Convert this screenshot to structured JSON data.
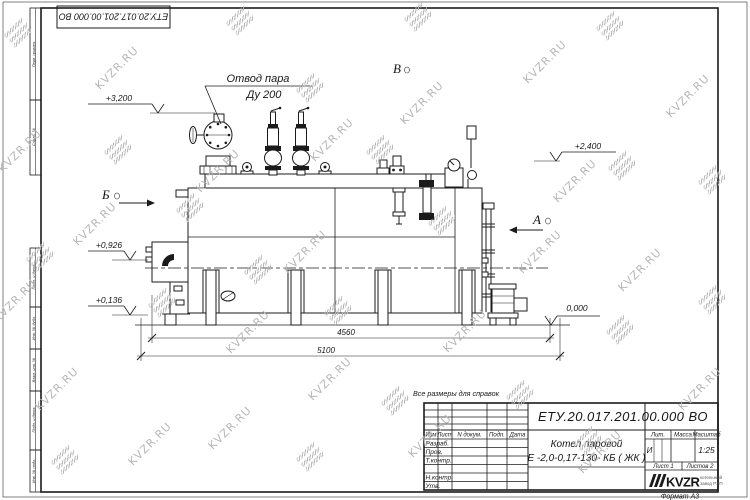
{
  "doc": {
    "number": "ЕТУ.20.017.201.00.000  ВО"
  },
  "notes": {
    "reference": "Все размеры для справок",
    "format": "Формат А3"
  },
  "frame": {
    "side_columns": [
      "Перв. примен.",
      "Справ. №",
      "Подп. и дата",
      "Инв. № дубл.",
      "Взам. инв. №",
      "Подп. и дата",
      "Инв. № подл."
    ]
  },
  "drawing": {
    "callout": {
      "line1": "Отвод пара",
      "line2": "Ду 200"
    },
    "views": {
      "b": "Б",
      "a": "А",
      "v": "В"
    },
    "elevations": {
      "top": "+3,200",
      "drum": "+2,400",
      "burner": "+0,926",
      "base": "+0,136",
      "ground": "0,000"
    },
    "dimensions": {
      "axes": "4560",
      "overall": "5100"
    }
  },
  "title_block": {
    "name_line1": "Котел паровой",
    "name_line2": "Е -2,0-0,17-130- КБ ( ЖК )",
    "header_cols": [
      "Изм",
      "Лист",
      "N докум.",
      "Подп.",
      "Дата"
    ],
    "sig_rows": [
      "Разраб.",
      "Пров.",
      "Т.контр.",
      "Н.контр.",
      "Утв."
    ],
    "lit_label": "Лит.",
    "mass_label": "Масса",
    "scale_label": "Масштаб",
    "lit_value": "И",
    "scale_value": "1:25",
    "sheet_cell": "Лист 1",
    "sheets_cell": "Листов 2",
    "logo_text": "KVZR",
    "logo_sub1": "котельный",
    "logo_sub2": "завод РЭП"
  },
  "watermarks": {
    "text": "KVZR.RU",
    "items": [
      {
        "t": "icon",
        "x": 18,
        "y": 33
      },
      {
        "t": "icon",
        "x": 240,
        "y": 21
      },
      {
        "t": "icon",
        "x": 418,
        "y": 17
      },
      {
        "t": "icon",
        "x": 610,
        "y": 26
      },
      {
        "t": "icon",
        "x": 310,
        "y": 88
      },
      {
        "t": "icon",
        "x": 118,
        "y": 150
      },
      {
        "t": "icon",
        "x": 380,
        "y": 150
      },
      {
        "t": "icon",
        "x": 622,
        "y": 166
      },
      {
        "t": "icon",
        "x": 190,
        "y": 208
      },
      {
        "t": "icon",
        "x": 442,
        "y": 221
      },
      {
        "t": "icon",
        "x": 712,
        "y": 180
      },
      {
        "t": "icon",
        "x": 40,
        "y": 257
      },
      {
        "t": "icon",
        "x": 258,
        "y": 270
      },
      {
        "t": "icon",
        "x": 162,
        "y": 303
      },
      {
        "t": "icon",
        "x": 338,
        "y": 311
      },
      {
        "t": "icon",
        "x": 712,
        "y": 300
      },
      {
        "t": "icon",
        "x": 620,
        "y": 330
      },
      {
        "t": "icon",
        "x": 520,
        "y": 395
      },
      {
        "t": "icon",
        "x": 395,
        "y": 401
      },
      {
        "t": "icon",
        "x": 65,
        "y": 460
      },
      {
        "t": "icon",
        "x": 310,
        "y": 457
      },
      {
        "t": "icon",
        "x": 588,
        "y": 441
      },
      {
        "t": "text",
        "x": 117,
        "y": 68
      },
      {
        "t": "text",
        "x": 20,
        "y": 151
      },
      {
        "t": "text",
        "x": 218,
        "y": 171
      },
      {
        "t": "text",
        "x": 332,
        "y": 140
      },
      {
        "t": "text",
        "x": 422,
        "y": 103
      },
      {
        "t": "text",
        "x": 545,
        "y": 62
      },
      {
        "t": "text",
        "x": 688,
        "y": 96
      },
      {
        "t": "text",
        "x": 95,
        "y": 224
      },
      {
        "t": "text",
        "x": 305,
        "y": 252
      },
      {
        "t": "text",
        "x": 540,
        "y": 252
      },
      {
        "t": "text",
        "x": 575,
        "y": 181
      },
      {
        "t": "text",
        "x": 640,
        "y": 270
      },
      {
        "t": "text",
        "x": 15,
        "y": 301
      },
      {
        "t": "text",
        "x": 248,
        "y": 332
      },
      {
        "t": "text",
        "x": 465,
        "y": 331
      },
      {
        "t": "text",
        "x": 57,
        "y": 389
      },
      {
        "t": "text",
        "x": 330,
        "y": 379
      },
      {
        "t": "text",
        "x": 700,
        "y": 389
      },
      {
        "t": "text",
        "x": 150,
        "y": 444
      },
      {
        "t": "text",
        "x": 230,
        "y": 428
      },
      {
        "t": "text",
        "x": 430,
        "y": 436
      },
      {
        "t": "text",
        "x": 600,
        "y": 452
      }
    ]
  }
}
